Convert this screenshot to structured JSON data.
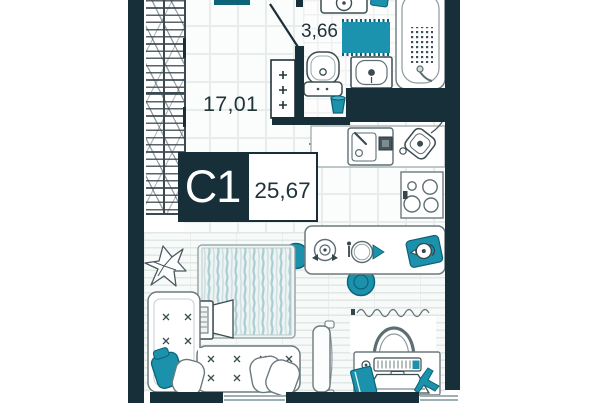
{
  "plan": {
    "unit_label": "С1",
    "total_area": "25,67",
    "room_area": "17,01",
    "bathroom_area": "3,66"
  },
  "colors": {
    "wall": "#172f39",
    "accent": "#1b91ac",
    "accent_dark": "#0d6378",
    "text": "#20343c",
    "outline": "#6b7a7e",
    "tile_line": "#e8edeb",
    "plank_line": "#dfe8e4"
  },
  "furniture_icons": [
    "plant-icon",
    "bed-icon",
    "sofa-icon",
    "pillow-icon",
    "tshirt-icon",
    "tv-cabinet-icon",
    "mirror-panel-icon",
    "curtain-icon",
    "desk-icon",
    "office-chair-icon",
    "keyboard-icon",
    "mouse-icon",
    "laptop-icon",
    "notebook-icon",
    "airplane-figurine-icon",
    "dining-table-icon",
    "stool-icon",
    "pot-icon",
    "place-setting-icon",
    "teapot-tray-icon",
    "kitchen-counter-icon",
    "kitchen-sink-icon",
    "kettle-icon",
    "stove-icon",
    "ceiling-light-icon",
    "vent-duct-icon",
    "door-swing-icon",
    "toilet-icon",
    "washbasin-icon",
    "washing-machine-icon",
    "bath-mat-icon",
    "bathtub-icon",
    "trash-bin-icon"
  ]
}
